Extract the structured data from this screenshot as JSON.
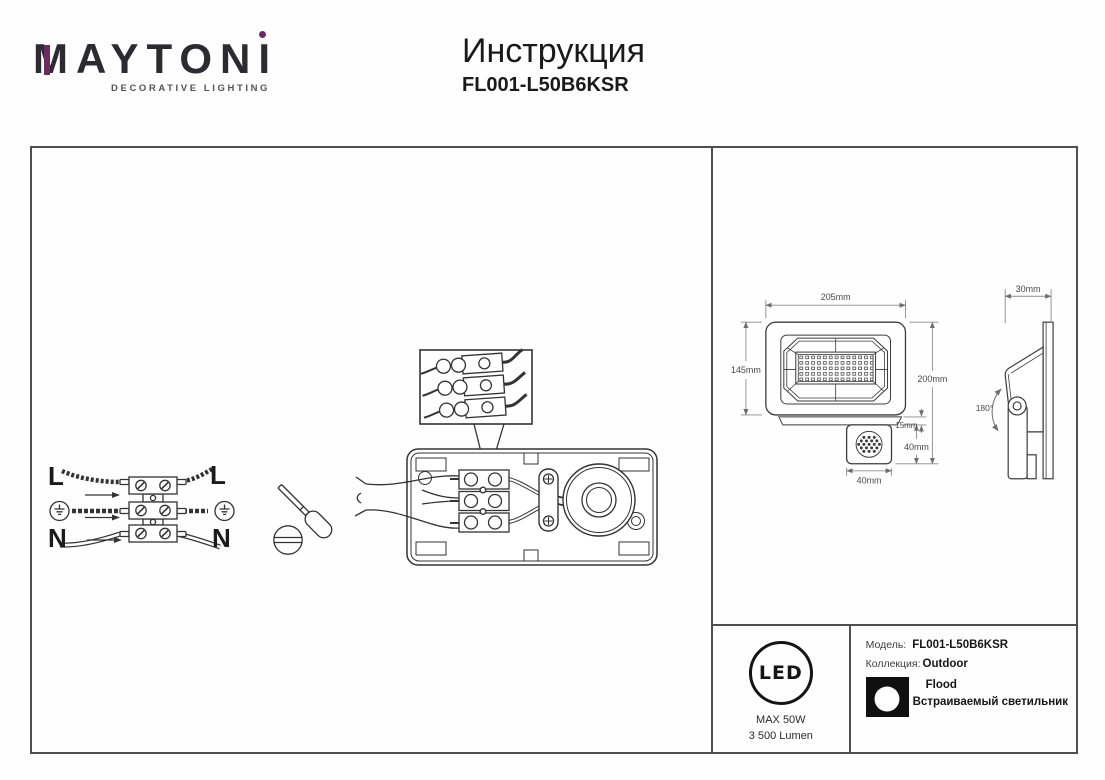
{
  "brand": {
    "m": "M",
    "mid": "AYTON",
    "i": "I",
    "tagline": "DECORATIVE LIGHTING",
    "accent_color": "#6b2a60",
    "ink_color": "#2d2b31"
  },
  "header": {
    "title": "Инструкция",
    "model": "FL001-L50B6KSR"
  },
  "wiring_diagram": {
    "live_left": "L",
    "neutral_left": "N",
    "live_right": "L",
    "neutral_right": "N"
  },
  "dimensions": {
    "front_width": "205mm",
    "front_height": "145mm",
    "overall_height": "200mm",
    "bracket_height": "15mm",
    "sensor_height": "40mm",
    "sensor_width": "40mm",
    "depth": "30mm",
    "rotation": "180°"
  },
  "spec_panel": {
    "led_text": "LED",
    "max_power": "MAX 50W",
    "luminous_flux": "3 500 Lumen",
    "model_label": "Модель:",
    "model_value": "FL001-L50B6KSR",
    "collection_label": "Коллекция:",
    "collection_value": "Outdoor",
    "type_value": "Flood",
    "type_description": "Встраиваемый светильник"
  }
}
